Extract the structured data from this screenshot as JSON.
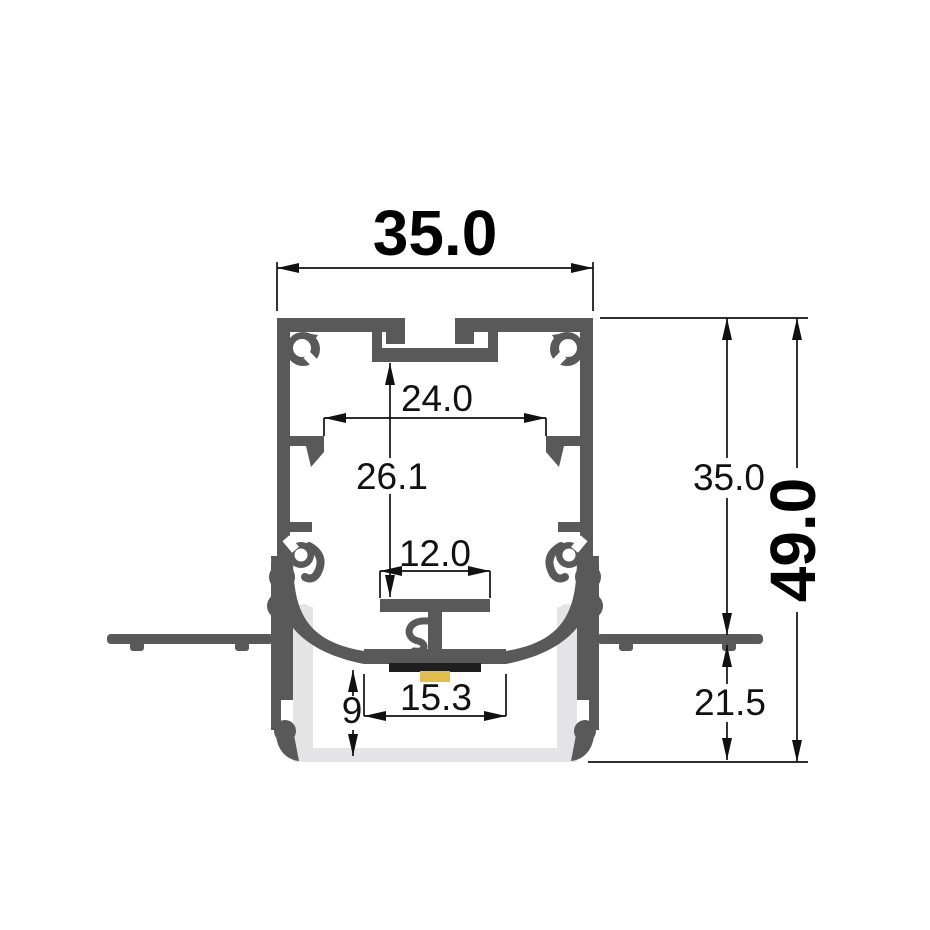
{
  "drawing": {
    "kind": "technical cross-section of recessed LED aluminium profile",
    "dims": {
      "overall_width": "35.0",
      "inner_clip_width": "24.0",
      "inner_height": "26.1",
      "pcb_shelf_width": "12.0",
      "lamp_opening_width": "15.3",
      "diffuser_depth": "9",
      "recess_depth": "35.0",
      "below_flange_height": "21.5",
      "overall_height": "49.0"
    },
    "colors": {
      "profile": "#595959",
      "diffuser": "#e4e4e7",
      "led_strip": "#e2bf4d",
      "pcb": "#1f1f1f",
      "dimension_lines": "#111111",
      "background": "#ffffff"
    }
  }
}
